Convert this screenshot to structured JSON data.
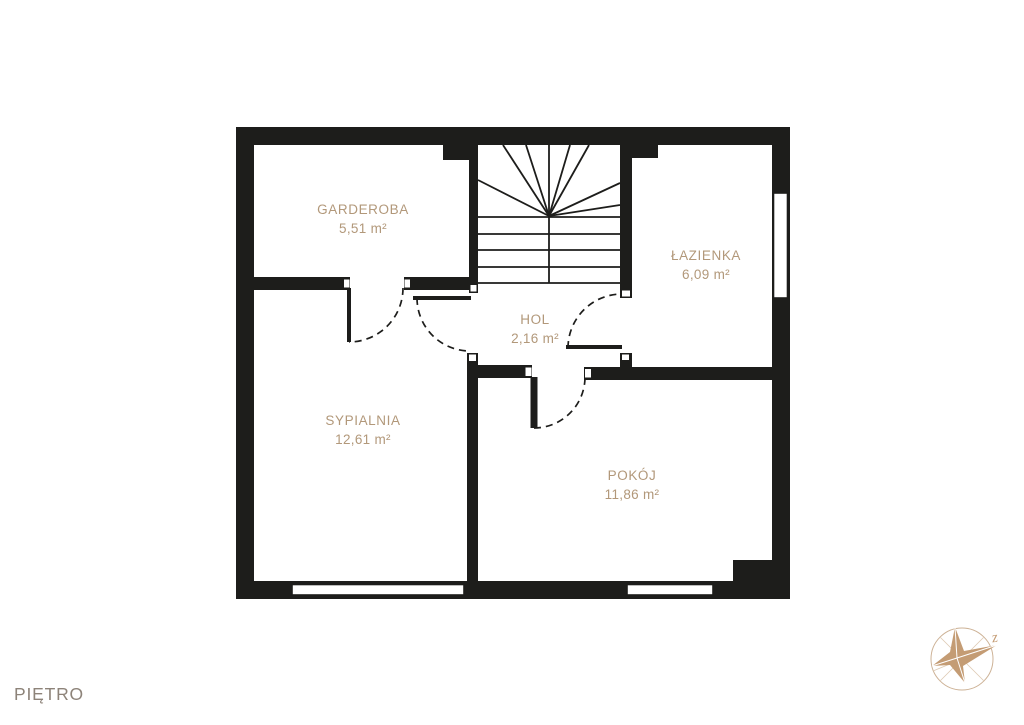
{
  "floor_label": "PIĘTRO",
  "compass": {
    "direction_label": "z"
  },
  "rooms": [
    {
      "id": "garderoba",
      "name": "GARDEROBA",
      "area": "5,51 m²"
    },
    {
      "id": "lazienka",
      "name": "ŁAZIENKA",
      "area": "6,09 m²"
    },
    {
      "id": "hol",
      "name": "HOL",
      "area": "2,16 m²"
    },
    {
      "id": "sypialnia",
      "name": "SYPIALNIA",
      "area": "12,61 m²"
    },
    {
      "id": "pokoj",
      "name": "POKÓJ",
      "area": "11,86 m²"
    }
  ],
  "colors": {
    "wall": "#1d1d1b",
    "room_label": "#b2987a",
    "floor_label": "#8d8379",
    "compass_star": "#c49c74",
    "compass_ring": "#cdb296",
    "background": "#ffffff"
  }
}
